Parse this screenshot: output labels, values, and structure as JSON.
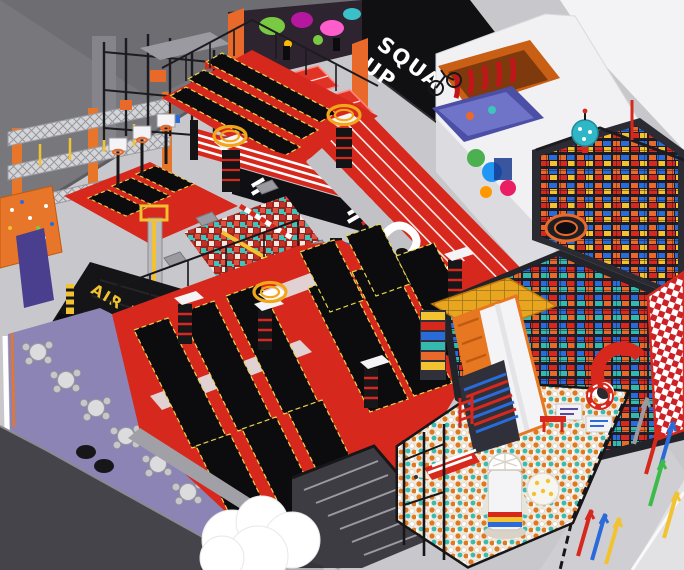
{
  "scene": {
    "title": "Indoor trampoline and adventure park — isometric 3D overview render",
    "view": "aerial isometric"
  },
  "signs": {
    "squad_up_line1": "SQUAD",
    "squad_up_line2": "UP",
    "air_bag": "AIR BAG"
  },
  "palette": {
    "floor_gray": "#c8c8cc",
    "upper_wall_gray": "#77777c",
    "dark_wall": "#44444a",
    "sign_wall_black": "#101013",
    "sign_text_white": "#ffffff",
    "airbag_black": "#151517",
    "airbag_text_yellow": "#f2c230",
    "court_red": "#d7281e",
    "trampoline_bed_black": "#0c0c0e",
    "bed_trim_yellow": "#e8d44d",
    "ninja_orange": "#e8762a",
    "foam_teal": "#3fc4bc",
    "cafe_purple": "#8b84b5",
    "roof_white": "#f1f1f3",
    "ballpit_orange": "#e07820",
    "playground_blue": "#2b6bd9",
    "checker_red": "#cc2127",
    "track_red": "#d7281e"
  },
  "zones": [
    {
      "name": "ninja-truss-course",
      "label": "Ninja obstacle truss course"
    },
    {
      "name": "adventure-frame",
      "label": "Ropes adventure frame"
    },
    {
      "name": "climbing-wall",
      "label": "Climbing wall"
    },
    {
      "name": "dodgeball-court",
      "label": "Glow dodgeball courts with graffiti wall"
    },
    {
      "name": "squad-up-wall",
      "label": "SQUAD UP feature wall"
    },
    {
      "name": "party-room",
      "label": "White-roof party room"
    },
    {
      "name": "top-trampoline-lanes",
      "label": "Upper trampoline lanes"
    },
    {
      "name": "dunk-lanes",
      "label": "Basketball dunk trampolines"
    },
    {
      "name": "foam-pit",
      "label": "Foam cube pit with balance beams"
    },
    {
      "name": "ring-platforms",
      "label": "Halo-ring jump platforms"
    },
    {
      "name": "air-bag-pit",
      "label": "Air bag landing pit"
    },
    {
      "name": "main-trampoline-court",
      "label": "Main trampoline court with wall-run beds"
    },
    {
      "name": "running-track",
      "label": "Red sprint track"
    },
    {
      "name": "stage-wall",
      "label": "Performance stage wall"
    },
    {
      "name": "soft-play-structure",
      "label": "Multi-level soft play structure with slides"
    },
    {
      "name": "ball-pit",
      "label": "Ball pit with rocket tower"
    },
    {
      "name": "cafe-seating",
      "label": "Cafe seating on purple floor"
    },
    {
      "name": "cloud-sculpture",
      "label": "White cloud sculpture"
    },
    {
      "name": "walkway-arrows",
      "label": "Wayfinding floor arrows"
    }
  ],
  "props": {
    "cafe_tables": 6,
    "bean_bags": 5,
    "halo_ring_platforms": 3,
    "floor_arrow_colors": [
      "red",
      "blue",
      "gray",
      "green",
      "yellow"
    ]
  }
}
